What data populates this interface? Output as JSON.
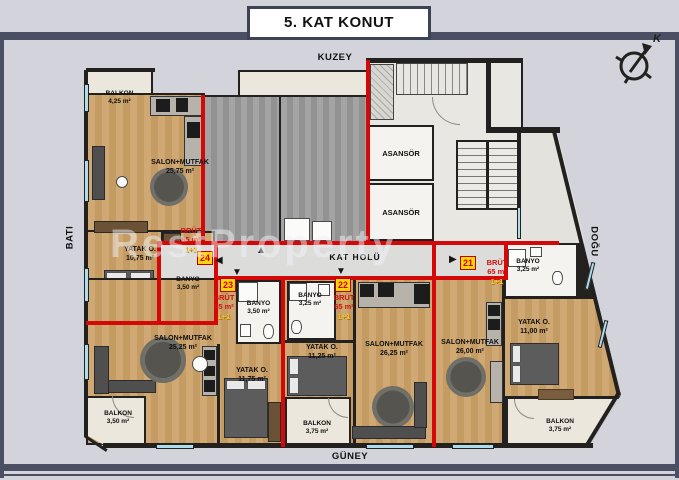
{
  "title": "5. KAT KONUT",
  "compass": {
    "label": "K"
  },
  "directions": {
    "north": "KUZEY",
    "south": "GÜNEY",
    "west": "BATI",
    "east": "DOĞU"
  },
  "common": {
    "hall": "KAT HOLÜ"
  },
  "elevators": [
    "ASANSÖR",
    "ASANSÖR"
  ],
  "watermark": "RestProperty",
  "arrows": {
    "left": "◀",
    "right": "▶",
    "up": "▲",
    "down": "▼"
  },
  "colors": {
    "boundary_red": "#d40808",
    "unit_badge_yellow": "#ffd60a",
    "brut_red": "#d01111",
    "window_blue": "#aedcec"
  },
  "units": {
    "u21": {
      "no": "21",
      "brut": "BRÜT",
      "area": "65 m²",
      "type": "1+1"
    },
    "u22": {
      "no": "22",
      "brut": "BRÜT",
      "area": "65 m²",
      "type": "1+1"
    },
    "u23": {
      "no": "23",
      "brut": "BRÜT",
      "area": "65 m²",
      "type": "1+1"
    },
    "u24": {
      "no": "24",
      "brut": "BRÜT",
      "area": "65 m²",
      "type": "1+1"
    }
  },
  "rooms": {
    "a24_balkon": {
      "label": "BALKON",
      "area": "4,25 m²"
    },
    "a24_salon": {
      "label": "SALON+MUTFAK",
      "area": "25,75 m²"
    },
    "a24_yatak": {
      "label": "YATAK O.",
      "area": "10,75 m²"
    },
    "a24_banyo": {
      "label": "BANYO",
      "area": "3,50 m²"
    },
    "a23_banyo": {
      "label": "BANYO",
      "area": "3,50 m²"
    },
    "a23_salon": {
      "label": "SALON+MUTFAK",
      "area": "25,25 m²"
    },
    "a23_yatak": {
      "label": "YATAK O.",
      "area": "11,75 m²"
    },
    "a23_balkon": {
      "label": "BALKON",
      "area": "3,50 m²"
    },
    "a22_banyo": {
      "label": "BANYO",
      "area": "3,25 m²"
    },
    "a22_yatak": {
      "label": "YATAK O.",
      "area": "11,25 m²"
    },
    "a22_salon": {
      "label": "SALON+MUTFAK",
      "area": "26,25 m²"
    },
    "a22_balkon": {
      "label": "BALKON",
      "area": "3,75 m²"
    },
    "a21_banyo": {
      "label": "BANYO",
      "area": "3,25 m²"
    },
    "a21_salon": {
      "label": "SALON+MUTFAK",
      "area": "26,00 m²"
    },
    "a21_yatak": {
      "label": "YATAK O.",
      "area": "11,00 m²"
    },
    "a21_balkon": {
      "label": "BALKON",
      "area": "3,75 m²"
    }
  }
}
